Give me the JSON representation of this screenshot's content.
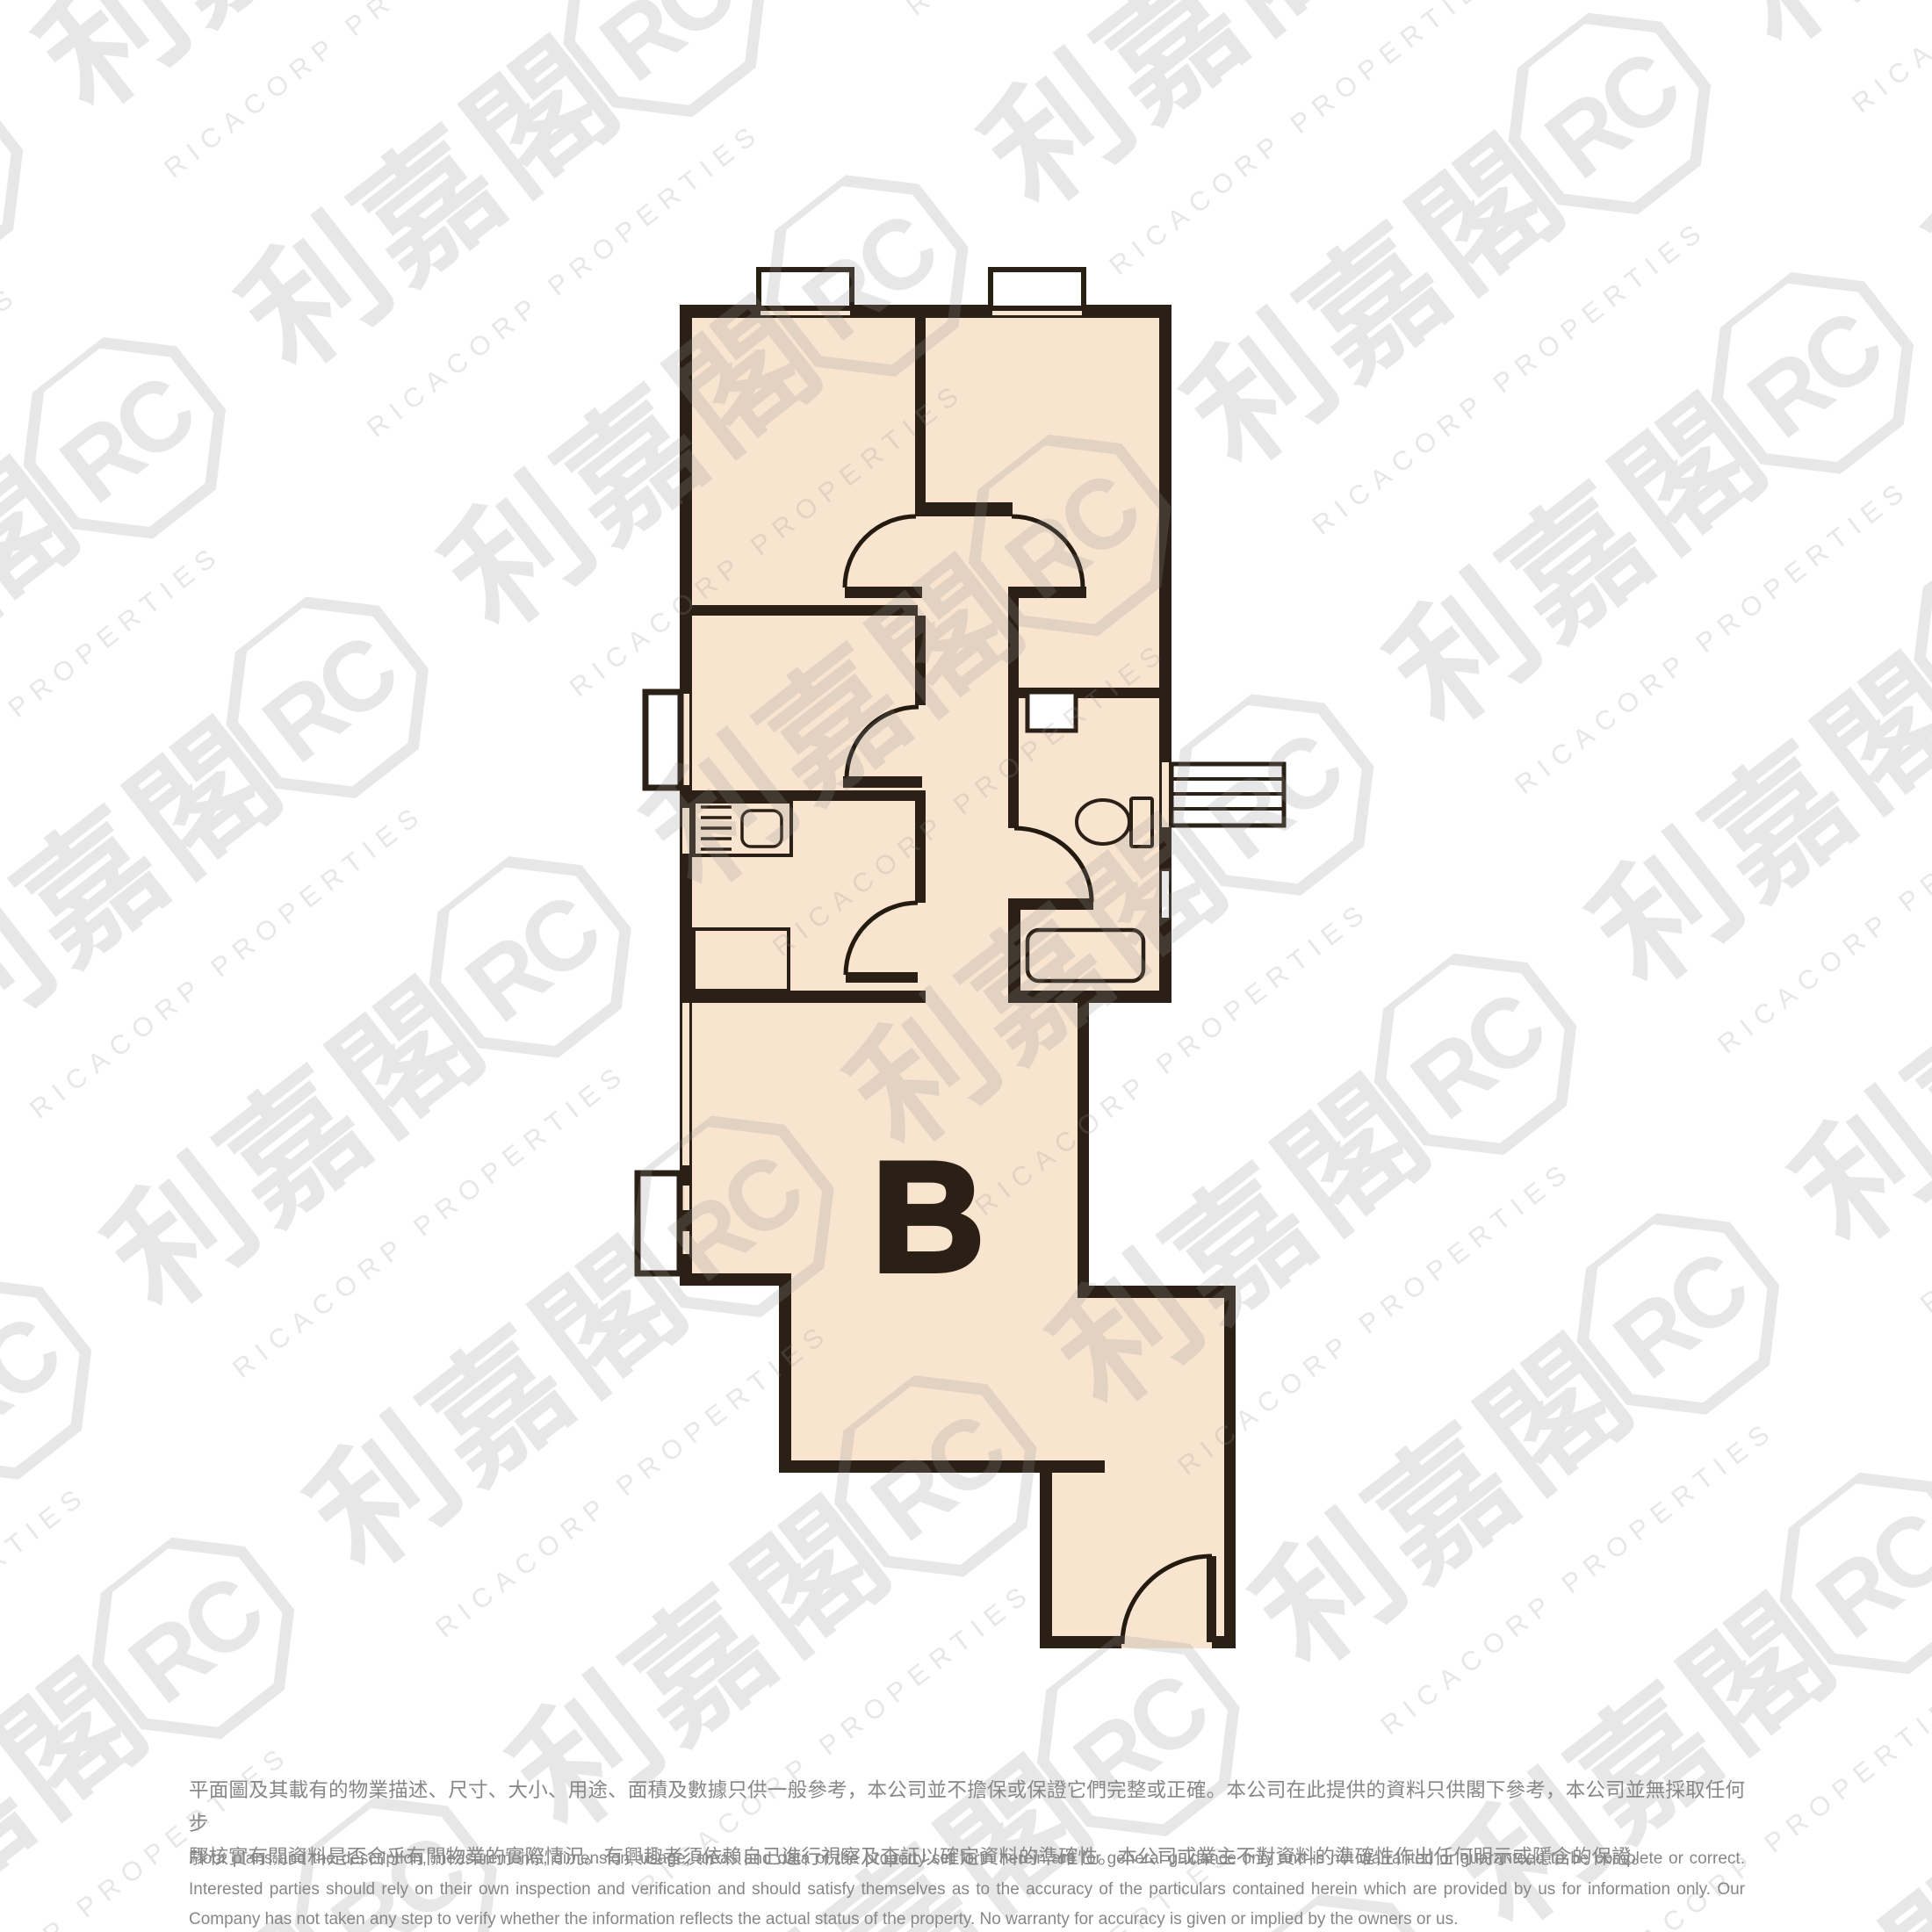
{
  "page": {
    "background_color": "#ffffff",
    "type_note": "real-estate floor plan image"
  },
  "floor_plan": {
    "unit_label": "B",
    "colors": {
      "floor_fill": "#f9e4d0",
      "wall": "#2b2016",
      "window_fill": "#ffffff",
      "label": "#2b2016"
    },
    "icons": [
      "stove-icon",
      "sink-icon",
      "toilet-icon",
      "bathtub-icon",
      "door-arc-icon",
      "window-icon",
      "louvre-window-icon"
    ]
  },
  "watermark": {
    "brand_cjk": "利嘉閣",
    "brand_en": "RICACORP PROPERTIES",
    "logo_monogram": "RC",
    "color": "#8f8f8f"
  },
  "disclaimer": {
    "zh_lines": [
      "平面圖及其載有的物業描述、尺寸、大小、用途、面積及數據只供一般參考，本公司並不擔保或保證它們完整或正確。本公司在此提供的資料只供閣下參考，本公司並無採取任何步",
      "驟核實有關資料是否合乎有關物業的實際情況。有興趣者須依賴自己進行視察及查証以確定資料的準確性。本公司或業主不對資料的準確性作出任何明示或隱含的保證。"
    ],
    "en_lines": [
      "Floor plans and the description, measurements, dimension, usage, areas and data of the property set forth herein are for general guidance only and is not warranted or guaranteed to be complete or correct.",
      "Interested parties should rely on their own inspection and verification and should satisfy themselves as to the accuracy of the particulars contained herein which are provided by us for information only.  Our",
      "Company has not taken any step to verify whether the information reflects the actual status of the property.  No warranty for accuracy is given or implied by the owners or us."
    ]
  }
}
